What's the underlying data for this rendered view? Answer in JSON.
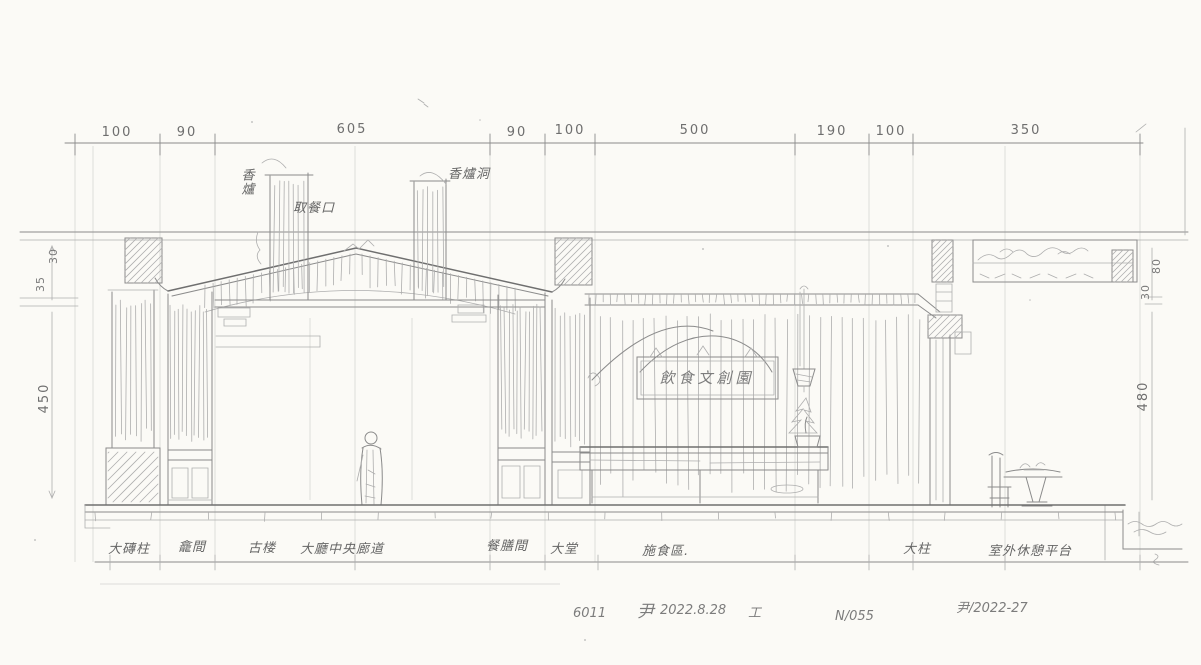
{
  "sheet": {
    "kind": "hand-drawn interior elevation sketch (scanned pencil drawing)",
    "paper_color": "#fbfaf6",
    "pencil_color": "#8b8b8b"
  },
  "dims_top": [
    "100",
    "90",
    "605",
    "90",
    "100",
    "500",
    "190",
    "100",
    "350"
  ],
  "dims_left": [
    "30",
    "35",
    "450"
  ],
  "dims_right": [
    "80",
    "30",
    "480"
  ],
  "callouts": {
    "incense_stand": "香爐",
    "window": "取餐口",
    "incense_vent": "香爐洞"
  },
  "signboard": "飲食文創園",
  "rooms": [
    "大磚柱",
    "龕間",
    "古楼",
    "大廳中央廊道",
    "餐膳間",
    "大堂",
    "施食區.",
    "大柱",
    "室外休憩平台"
  ],
  "notes": {
    "code": "6011",
    "signature": "尹",
    "date": "2022.8.28",
    "suffix": "工",
    "sheet_no": "N/055",
    "revision": "尹/2022-27"
  }
}
